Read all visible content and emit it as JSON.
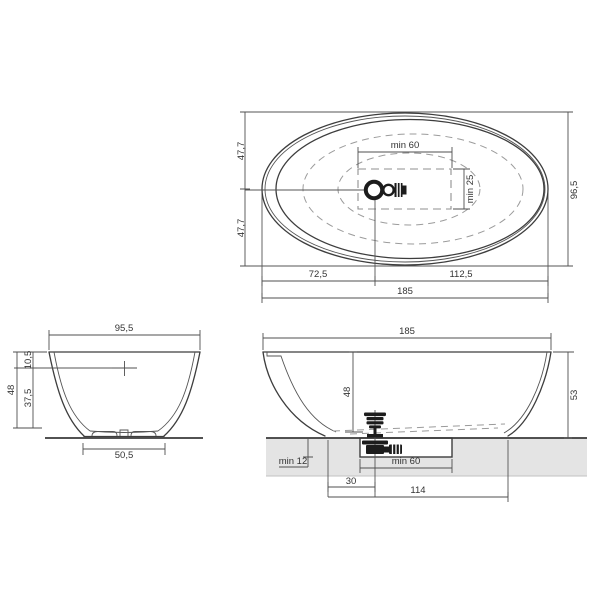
{
  "page": {
    "background": "#ffffff",
    "line_color": "#3d3d3d",
    "dashed_color": "#999999",
    "slab_color": "#e4e4e4",
    "fitting_color": "#1c1c1c"
  },
  "top_view": {
    "half_width_upper": "47,7",
    "half_width_lower": "47,7",
    "overall_width": "96,5",
    "clearance_length": "min 60",
    "clearance_width": "min 25",
    "drain_from_left": "72,5",
    "drain_to_right": "112,5",
    "overall_length": "185"
  },
  "front_view": {
    "rim_width": "95,5",
    "overflow_depth": "10,5",
    "lower_depth": "37,5",
    "inner_depth": "48",
    "base_width": "50,5"
  },
  "side_view": {
    "overall_length": "185",
    "inner_depth": "48",
    "overall_height": "53",
    "recess_depth": "min 12",
    "recess_length": "min 60",
    "drain_offset": "30",
    "base_length": "114"
  }
}
